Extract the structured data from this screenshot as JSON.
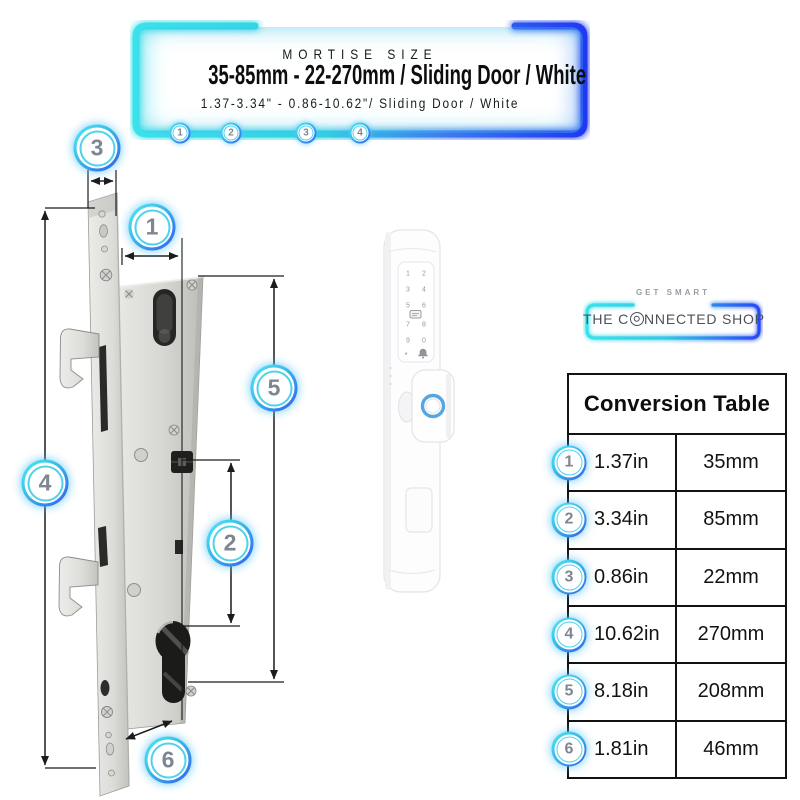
{
  "header": {
    "eyebrow": "MORTISE SIZE",
    "title": "35-85mm - 22-270mm / Sliding Door / White",
    "subtitle": "1.37-3.34\" - 0.86-10.62\"/ Sliding Door / White",
    "callouts": [
      "1",
      "2",
      "3",
      "4"
    ]
  },
  "diagram": {
    "description": "mortise-lock-technical-drawing-with-dimension-callouts",
    "callouts": [
      "3",
      "1",
      "5",
      "4",
      "2",
      "6"
    ]
  },
  "product": {
    "description": "white-slim-smart-door-lock-with-keypad-and-fingerprint-knob",
    "keypad": [
      "1",
      "2",
      "3",
      "4",
      "5",
      "6",
      "7",
      "8",
      "9",
      "0",
      "*"
    ],
    "icons": {
      "card": "rfid-card-icon",
      "bell": "doorbell-icon",
      "fingerprint": "fingerprint-ring-icon"
    }
  },
  "logo": {
    "eyebrow": "GET SMART",
    "name_pre": "THE C",
    "name_post": "NNECTED SHOP",
    "icons": {
      "o": "stylized-o-icon"
    }
  },
  "conversion_table": {
    "title": "Conversion Table",
    "rows": [
      {
        "num": "1",
        "inches": "1.37in",
        "mm": "35mm"
      },
      {
        "num": "2",
        "inches": "3.34in",
        "mm": "85mm"
      },
      {
        "num": "3",
        "inches": "0.86in",
        "mm": "22mm"
      },
      {
        "num": "4",
        "inches": "10.62in",
        "mm": "270mm"
      },
      {
        "num": "5",
        "inches": "8.18in",
        "mm": "208mm"
      },
      {
        "num": "6",
        "inches": "1.81in",
        "mm": "46mm"
      }
    ]
  },
  "colors": {
    "neon_cyan": "#3bd8e7",
    "neon_blue": "#2744f3",
    "fingerprint_ring_blue": "#55a7e3",
    "callout_number_gray": "#7e8691"
  }
}
